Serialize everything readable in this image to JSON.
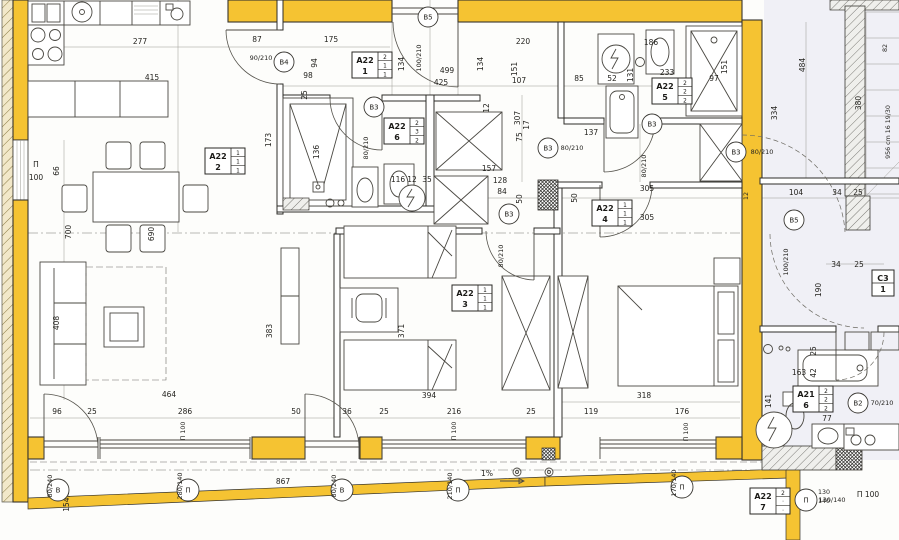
{
  "drawing": {
    "type": "architectural-floor-plan",
    "slope_label": "1%",
    "stair_note": "956 cm 16 19/30",
    "colors": {
      "wall_yellow": "#f5c332",
      "line": "#3a3936",
      "tint": "#eef0f5"
    }
  },
  "room_labels": [
    {
      "name": "A22",
      "num": "1",
      "cells": [
        "2",
        "1",
        "1"
      ],
      "x": 352,
      "y": 52
    },
    {
      "name": "A22",
      "num": "2",
      "cells": [
        "1",
        "1",
        "1"
      ],
      "x": 205,
      "y": 148
    },
    {
      "name": "A22",
      "num": "3",
      "cells": [
        "1",
        "1",
        "1"
      ],
      "x": 452,
      "y": 285
    },
    {
      "name": "A22",
      "num": "4",
      "cells": [
        "1",
        "1",
        "1"
      ],
      "x": 592,
      "y": 200
    },
    {
      "name": "A22",
      "num": "5",
      "cells": [
        "2",
        "2",
        "2"
      ],
      "x": 652,
      "y": 78
    },
    {
      "name": "A22",
      "num": "6",
      "cells": [
        "2",
        "3",
        "2"
      ],
      "x": 384,
      "y": 118
    },
    {
      "name": "A21",
      "num": "6",
      "cells": [
        "2",
        "2",
        "2"
      ],
      "x": 793,
      "y": 386
    },
    {
      "name": "A22",
      "num": "7",
      "cells": [
        "2",
        "·",
        "·"
      ],
      "x": 750,
      "y": 488
    },
    {
      "name": "C3",
      "num": "1",
      "cells": [],
      "x": 872,
      "y": 270
    }
  ],
  "door_tags": [
    {
      "tag": "B4",
      "size": "90/210",
      "cx": 284,
      "cy": 62,
      "tx": 261,
      "ty": 60,
      "rot": 0
    },
    {
      "tag": "B5",
      "size": "100/210",
      "cx": 428,
      "cy": 17,
      "tx": 421,
      "ty": 58,
      "rot": 1
    },
    {
      "tag": "B3",
      "size": "80/210",
      "cx": 374,
      "cy": 107,
      "tx": 368,
      "ty": 148,
      "rot": 1
    },
    {
      "tag": "B3",
      "size": "80/210",
      "cx": 548,
      "cy": 148,
      "tx": 572,
      "ty": 150,
      "rot": 0
    },
    {
      "tag": "B3",
      "size": "80/210",
      "cx": 652,
      "cy": 124,
      "tx": 646,
      "ty": 166,
      "rot": 1
    },
    {
      "tag": "B3",
      "size": "80/210",
      "cx": 736,
      "cy": 152,
      "tx": 762,
      "ty": 154,
      "rot": 0
    },
    {
      "tag": "B3",
      "size": "80/210",
      "cx": 509,
      "cy": 214,
      "tx": 503,
      "ty": 256,
      "rot": 1
    },
    {
      "tag": "B5",
      "size": "100/210",
      "cx": 794,
      "cy": 220,
      "tx": 788,
      "ty": 262,
      "rot": 1
    },
    {
      "tag": "B2",
      "size": "70/210",
      "cx": 858,
      "cy": 403,
      "tx": 882,
      "ty": 405,
      "rot": 0
    }
  ],
  "window_tags": [
    {
      "tag": "В",
      "size": "80/240",
      "cx": 58,
      "cy": 490,
      "tx": 52,
      "ty": 486,
      "rot": 1
    },
    {
      "tag": "П",
      "size": "280/140",
      "cx": 188,
      "cy": 490,
      "tx": 182,
      "ty": 486,
      "rot": 1
    },
    {
      "tag": "В",
      "size": "80/240",
      "cx": 342,
      "cy": 490,
      "tx": 336,
      "ty": 486,
      "rot": 1
    },
    {
      "tag": "П",
      "size": "210/140",
      "cx": 458,
      "cy": 490,
      "tx": 452,
      "ty": 486,
      "rot": 1
    },
    {
      "tag": "П",
      "size": "170/140",
      "cx": 682,
      "cy": 487,
      "tx": 676,
      "ty": 483,
      "rot": 1
    },
    {
      "tag": "П",
      "size": "130/140",
      "cx": 806,
      "cy": 500,
      "tx": 832,
      "ty": 502,
      "rot": 0
    }
  ],
  "dims": [
    {
      "t": "277",
      "x": 140,
      "y": 44
    },
    {
      "t": "415",
      "x": 152,
      "y": 80
    },
    {
      "t": "87",
      "x": 257,
      "y": 42
    },
    {
      "t": "175",
      "x": 331,
      "y": 42
    },
    {
      "t": "98",
      "x": 308,
      "y": 78
    },
    {
      "t": "94",
      "x": 317,
      "y": 63,
      "r": 1
    },
    {
      "t": "25",
      "x": 307,
      "y": 95,
      "r": 1
    },
    {
      "t": "173",
      "x": 271,
      "y": 140,
      "r": 1
    },
    {
      "t": "136",
      "x": 319,
      "y": 152,
      "r": 1
    },
    {
      "t": "220",
      "x": 523,
      "y": 44
    },
    {
      "t": "499",
      "x": 447,
      "y": 73
    },
    {
      "t": "425",
      "x": 441,
      "y": 85
    },
    {
      "t": "107",
      "x": 519,
      "y": 83
    },
    {
      "t": "134",
      "x": 404,
      "y": 64,
      "r": 1
    },
    {
      "t": "134",
      "x": 483,
      "y": 64,
      "r": 1
    },
    {
      "t": "151",
      "x": 517,
      "y": 69,
      "r": 1
    },
    {
      "t": "85",
      "x": 579,
      "y": 81
    },
    {
      "t": "12",
      "x": 489,
      "y": 108,
      "r": 1
    },
    {
      "t": "307",
      "x": 520,
      "y": 118,
      "r": 1
    },
    {
      "t": "17",
      "x": 529,
      "y": 125,
      "r": 1
    },
    {
      "t": "75",
      "x": 522,
      "y": 137,
      "r": 1
    },
    {
      "t": "52",
      "x": 612,
      "y": 81
    },
    {
      "t": "131",
      "x": 633,
      "y": 75,
      "r": 1
    },
    {
      "t": "186",
      "x": 651,
      "y": 45
    },
    {
      "t": "233",
      "x": 667,
      "y": 75
    },
    {
      "t": "97",
      "x": 714,
      "y": 81
    },
    {
      "t": "151",
      "x": 727,
      "y": 67,
      "r": 1
    },
    {
      "t": "484",
      "x": 805,
      "y": 65,
      "r": 1
    },
    {
      "t": "380",
      "x": 861,
      "y": 103,
      "r": 1
    },
    {
      "t": "334",
      "x": 777,
      "y": 113,
      "r": 1
    },
    {
      "t": "137",
      "x": 591,
      "y": 135
    },
    {
      "t": "104",
      "x": 796,
      "y": 195
    },
    {
      "t": "34",
      "x": 837,
      "y": 195
    },
    {
      "t": "25",
      "x": 858,
      "y": 195
    },
    {
      "t": "34",
      "x": 836,
      "y": 267
    },
    {
      "t": "25",
      "x": 859,
      "y": 267
    },
    {
      "t": "190",
      "x": 821,
      "y": 290,
      "r": 1
    },
    {
      "t": "305",
      "x": 647,
      "y": 191
    },
    {
      "t": "305",
      "x": 647,
      "y": 220
    },
    {
      "t": "157",
      "x": 489,
      "y": 171
    },
    {
      "t": "128",
      "x": 500,
      "y": 183
    },
    {
      "t": "84",
      "x": 502,
      "y": 194
    },
    {
      "t": "50",
      "x": 522,
      "y": 199,
      "r": 1
    },
    {
      "t": "50",
      "x": 577,
      "y": 198,
      "r": 1
    },
    {
      "t": "116",
      "x": 398,
      "y": 182
    },
    {
      "t": "12",
      "x": 412,
      "y": 182
    },
    {
      "t": "35",
      "x": 427,
      "y": 182
    },
    {
      "t": "66",
      "x": 59,
      "y": 171,
      "r": 1
    },
    {
      "t": "700",
      "x": 71,
      "y": 232,
      "r": 1
    },
    {
      "t": "690",
      "x": 154,
      "y": 234,
      "r": 1
    },
    {
      "t": "408",
      "x": 59,
      "y": 323,
      "r": 1
    },
    {
      "t": "383",
      "x": 272,
      "y": 331,
      "r": 1
    },
    {
      "t": "371",
      "x": 404,
      "y": 331,
      "r": 1
    },
    {
      "t": "394",
      "x": 429,
      "y": 398
    },
    {
      "t": "318",
      "x": 644,
      "y": 398
    },
    {
      "t": "464",
      "x": 169,
      "y": 397
    },
    {
      "t": "96",
      "x": 57,
      "y": 414
    },
    {
      "t": "25",
      "x": 92,
      "y": 414
    },
    {
      "t": "286",
      "x": 185,
      "y": 414
    },
    {
      "t": "50",
      "x": 296,
      "y": 414
    },
    {
      "t": "36",
      "x": 347,
      "y": 414
    },
    {
      "t": "25",
      "x": 384,
      "y": 414
    },
    {
      "t": "216",
      "x": 454,
      "y": 414
    },
    {
      "t": "25",
      "x": 531,
      "y": 414
    },
    {
      "t": "119",
      "x": 591,
      "y": 414
    },
    {
      "t": "176",
      "x": 682,
      "y": 414
    },
    {
      "t": "163",
      "x": 799,
      "y": 375
    },
    {
      "t": "42",
      "x": 816,
      "y": 373,
      "r": 1
    },
    {
      "t": "141",
      "x": 771,
      "y": 401,
      "r": 1
    },
    {
      "t": "77",
      "x": 827,
      "y": 421
    },
    {
      "t": "25",
      "x": 816,
      "y": 351,
      "r": 1
    },
    {
      "t": "867",
      "x": 283,
      "y": 484
    },
    {
      "t": "154,5",
      "x": 69,
      "y": 501,
      "r": 1
    },
    {
      "t": "1%",
      "x": 487,
      "y": 476
    },
    {
      "t": "П 100",
      "x": 185,
      "y": 431,
      "r": 1,
      "s": 1
    },
    {
      "t": "П 100",
      "x": 456,
      "y": 431,
      "r": 1,
      "s": 1
    },
    {
      "t": "П 100",
      "x": 688,
      "y": 432,
      "r": 1,
      "s": 1
    },
    {
      "t": "П",
      "x": 36,
      "y": 167
    },
    {
      "t": "100",
      "x": 36,
      "y": 180
    },
    {
      "t": "П 100",
      "x": 868,
      "y": 497
    },
    {
      "t": "130",
      "x": 824,
      "y": 494,
      "s": 1
    },
    {
      "t": "140",
      "x": 824,
      "y": 503,
      "s": 1
    },
    {
      "t": "956 cm 16 19/30",
      "x": 890,
      "y": 132,
      "r": 1,
      "s": 1
    },
    {
      "t": "82",
      "x": 887,
      "y": 48,
      "r": 1,
      "s": 1
    },
    {
      "t": "12",
      "x": 748,
      "y": 196,
      "r": 1,
      "s": 1
    }
  ]
}
